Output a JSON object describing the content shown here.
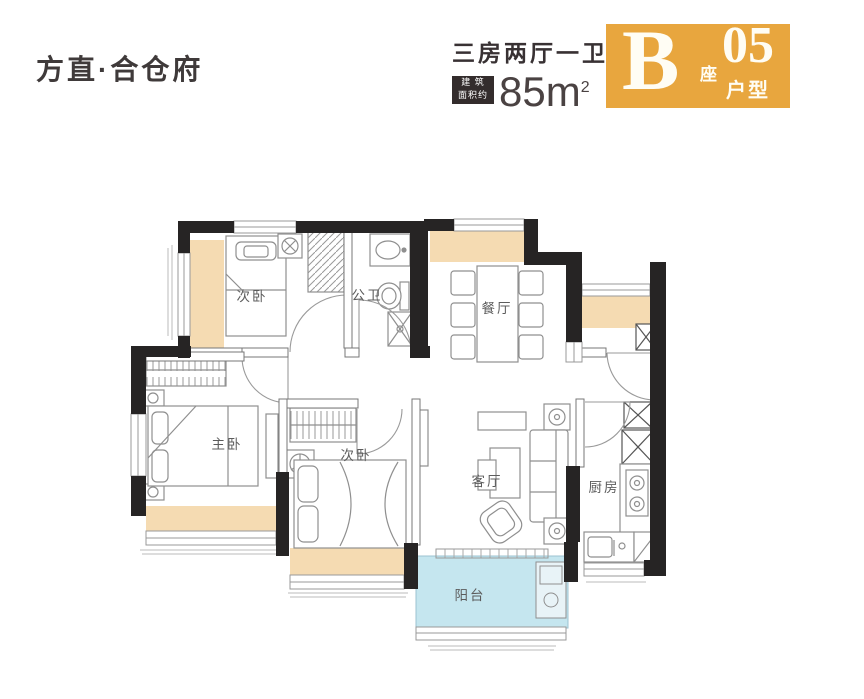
{
  "header": {
    "logo_text": "方直·合仓府",
    "plan_type": "三房两厅一卫",
    "area_badge_line1": "建 筑",
    "area_badge_line2": "面积约",
    "area_value": "85m",
    "area_sup": "2",
    "block_letter": "B",
    "block_suffix": "座",
    "unit_number": "05",
    "unit_suffix": "户型"
  },
  "floorplan": {
    "rooms": [
      {
        "id": "bedroom-top",
        "label": "次卧"
      },
      {
        "id": "bathroom",
        "label": "公卫"
      },
      {
        "id": "dining-room",
        "label": "餐厅"
      },
      {
        "id": "master-bedroom",
        "label": "主卧"
      },
      {
        "id": "bedroom-bottom",
        "label": "次卧"
      },
      {
        "id": "living-room",
        "label": "客厅"
      },
      {
        "id": "kitchen",
        "label": "厨房"
      },
      {
        "id": "balcony",
        "label": "阳台"
      }
    ],
    "colors": {
      "wall": "#262424",
      "bay_window_fill": "#F5DBB2",
      "balcony_fill": "#C5E6EF",
      "furniture_line": "#8f8f8f",
      "badge_bg": "#E8A63E",
      "area_badge_bg": "#332c2c"
    }
  }
}
